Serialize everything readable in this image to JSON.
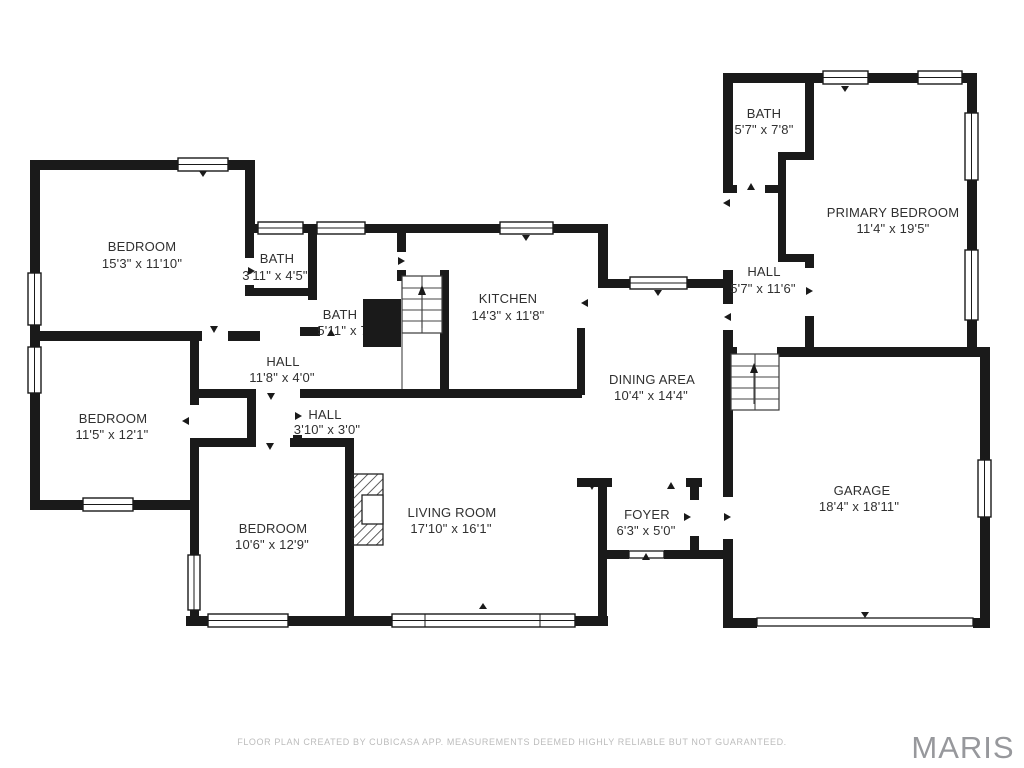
{
  "title": "Residential floor plan",
  "rooms": [
    {
      "name": "BEDROOM",
      "dims": "15'3\" x 11'10\""
    },
    {
      "name": "BATH",
      "dims": "3'11\" x 4'5\""
    },
    {
      "name": "BATH",
      "dims": "5'11\" x 7'"
    },
    {
      "name": "KITCHEN",
      "dims": "14'3\" x 11'8\""
    },
    {
      "name": "BATH",
      "dims": "5'7\" x 7'8\""
    },
    {
      "name": "PRIMARY BEDROOM",
      "dims": "11'4\" x 19'5\""
    },
    {
      "name": "HALL",
      "dims": "5'7\" x 11'6\""
    },
    {
      "name": "HALL",
      "dims": "11'8\" x 4'0\""
    },
    {
      "name": "BEDROOM",
      "dims": "11'5\" x 12'1\""
    },
    {
      "name": "HALL",
      "dims": "3'10\" x 3'0\""
    },
    {
      "name": "DINING AREA",
      "dims": "10'4\" x 14'4\""
    },
    {
      "name": "BEDROOM",
      "dims": "10'6\" x 12'9\""
    },
    {
      "name": "LIVING ROOM",
      "dims": "17'10\" x 16'1\""
    },
    {
      "name": "FOYER",
      "dims": "6'3\" x 5'0\""
    },
    {
      "name": "GARAGE",
      "dims": "18'4\" x 18'11\""
    }
  ],
  "footer": {
    "disclaimer": "FLOOR PLAN CREATED BY CUBICASA APP. MEASUREMENTS DEEMED HIGHLY RELIABLE BUT NOT GUARANTEED.",
    "brand": "MARIS"
  },
  "colors": {
    "wall": "#1a1a1a",
    "label": "#303030",
    "disclaimer_gray": "#bcbcbc",
    "brand_gray": "#97989c",
    "background": "#ffffff"
  }
}
